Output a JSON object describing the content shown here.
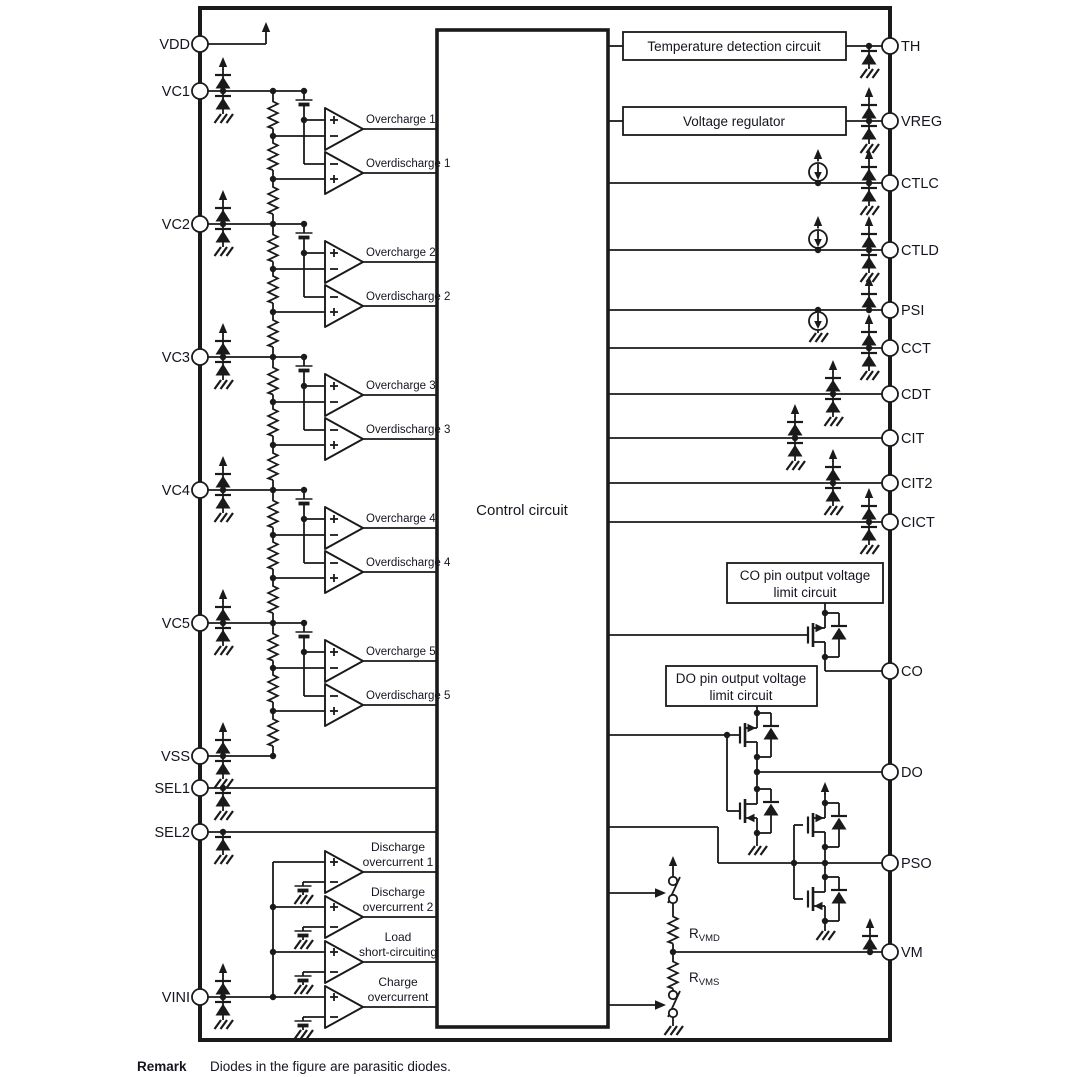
{
  "diagram": {
    "pins": {
      "left": [
        "VDD",
        "VC1",
        "VC2",
        "VC3",
        "VC4",
        "VC5",
        "VSS",
        "SEL1",
        "SEL2",
        "VINI"
      ],
      "right": [
        "TH",
        "VREG",
        "CTLC",
        "CTLD",
        "PSI",
        "CCT",
        "CDT",
        "CIT",
        "CIT2",
        "CICT",
        "CO",
        "DO",
        "PSO",
        "VM"
      ]
    },
    "blocks": {
      "control": "Control circuit",
      "temperature": "Temperature detection circuit",
      "regulator": "Voltage regulator",
      "co_limit": {
        "line1": "CO pin output voltage",
        "line2": "limit circuit"
      },
      "do_limit": {
        "line1": "DO pin output voltage",
        "line2": "limit circuit"
      }
    },
    "comparators": {
      "cells": [
        {
          "oc": "Overcharge 1",
          "od": "Overdischarge 1"
        },
        {
          "oc": "Overcharge 2",
          "od": "Overdischarge 2"
        },
        {
          "oc": "Overcharge 3",
          "od": "Overdischarge 3"
        },
        {
          "oc": "Overcharge 4",
          "od": "Overdischarge 4"
        },
        {
          "oc": "Overcharge 5",
          "od": "Overdischarge 5"
        }
      ],
      "current": [
        {
          "line1": "Discharge",
          "line2": "overcurrent 1"
        },
        {
          "line1": "Discharge",
          "line2": "overcurrent 2"
        },
        {
          "line1": "Load",
          "line2": "short-circuiting"
        },
        {
          "line1": "Charge",
          "line2": "overcurrent"
        }
      ]
    },
    "resistors": {
      "rvmd": {
        "base": "R",
        "sub": "VMD"
      },
      "rvms": {
        "base": "R",
        "sub": "VMS"
      }
    },
    "remark": {
      "label": "Remark",
      "text": "Diodes in the figure are parasitic diodes."
    },
    "colors": {
      "line": "#1a1a1a",
      "text": "#15151f",
      "background": "#ffffff"
    }
  }
}
